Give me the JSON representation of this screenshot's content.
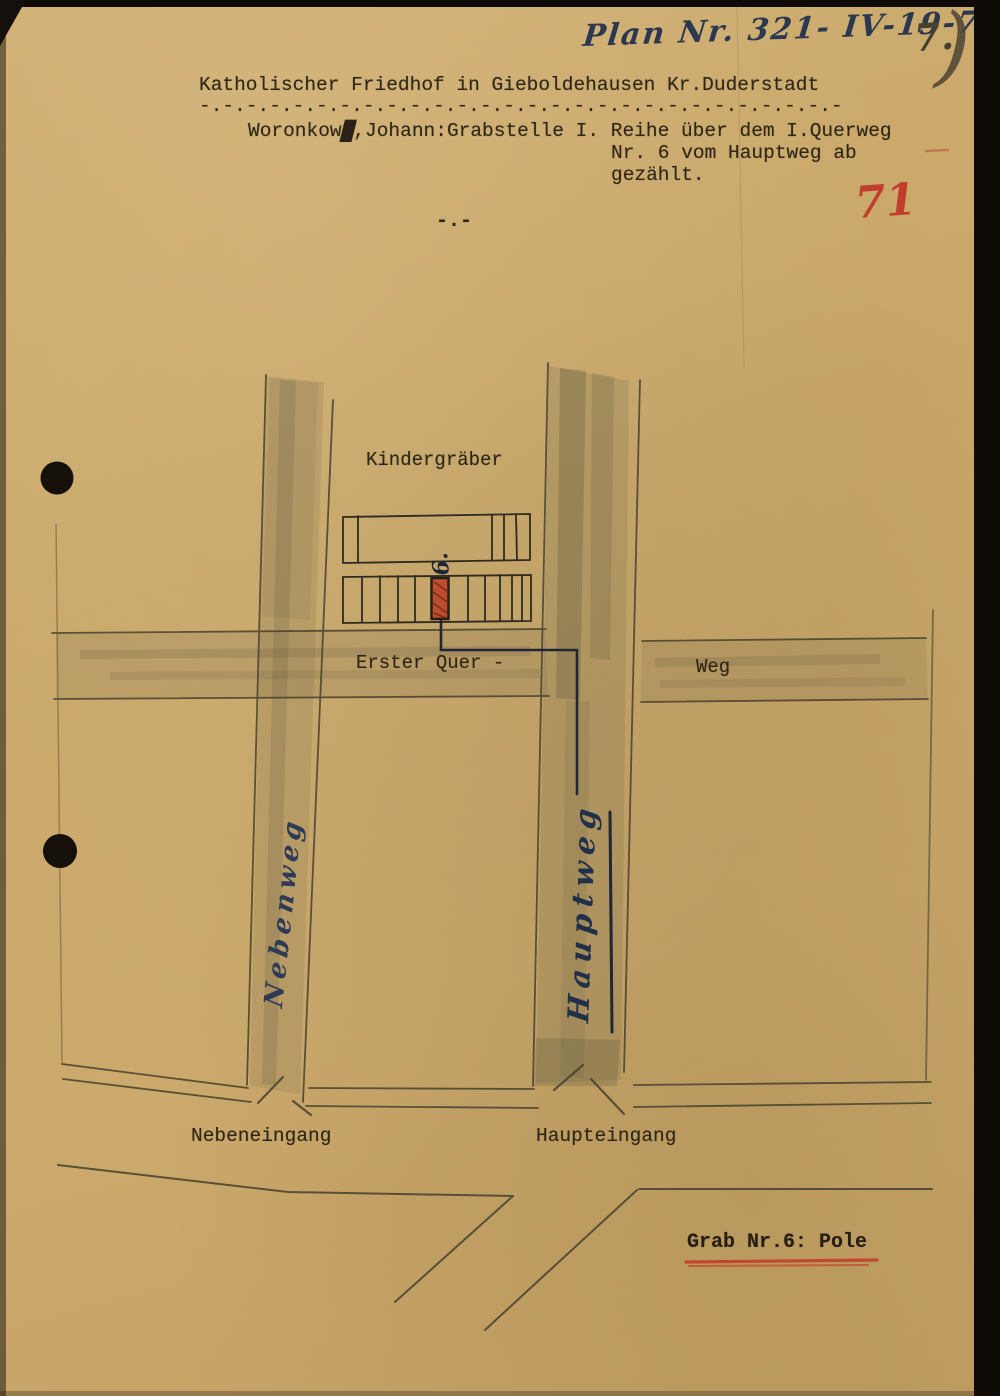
{
  "header": {
    "plan_line": "Plan Nr. 321- IV-19-7",
    "page_mark_number": "7.",
    "page_mark_paren": ")",
    "red_number": "71",
    "title": "Katholischer Friedhof in Gieboldehausen Kr.Duderstadt",
    "title_underline": "-.-.-.-.-.-.-.-.-.-.-.-.-.-.-.-.-.-.-.-.-.-.-.-.-.-.-.-",
    "record": {
      "name": "Woronkow",
      "struck_char": "█",
      "line1_rest": ",Johann:Grabstelle I. Reihe über dem I.Querweg",
      "line2": "Nr. 6 vom Hauptweg ab",
      "line3": "gezählt."
    },
    "separator": "-.-"
  },
  "map": {
    "area_label": "Kindergräber",
    "cross_path_label": "Erster Quer -",
    "cross_path_label_right": "Weg",
    "left_path_label": "Nebenweg",
    "main_path_label": "Hauptweg",
    "left_entrance_label": "Nebeneingang",
    "main_entrance_label": "Haupteingang",
    "marked_grave_number": "6."
  },
  "footer": {
    "grave_note": "Grab Nr.6: Pole"
  },
  "colors": {
    "paper": "#c9a76a",
    "pencil": "#45412f",
    "ink_blue": "#2a3550",
    "typewriter_ink": "#2e2718",
    "red_accent": "#c03e2b",
    "marked_grave_fill": "#bf4c2c"
  }
}
